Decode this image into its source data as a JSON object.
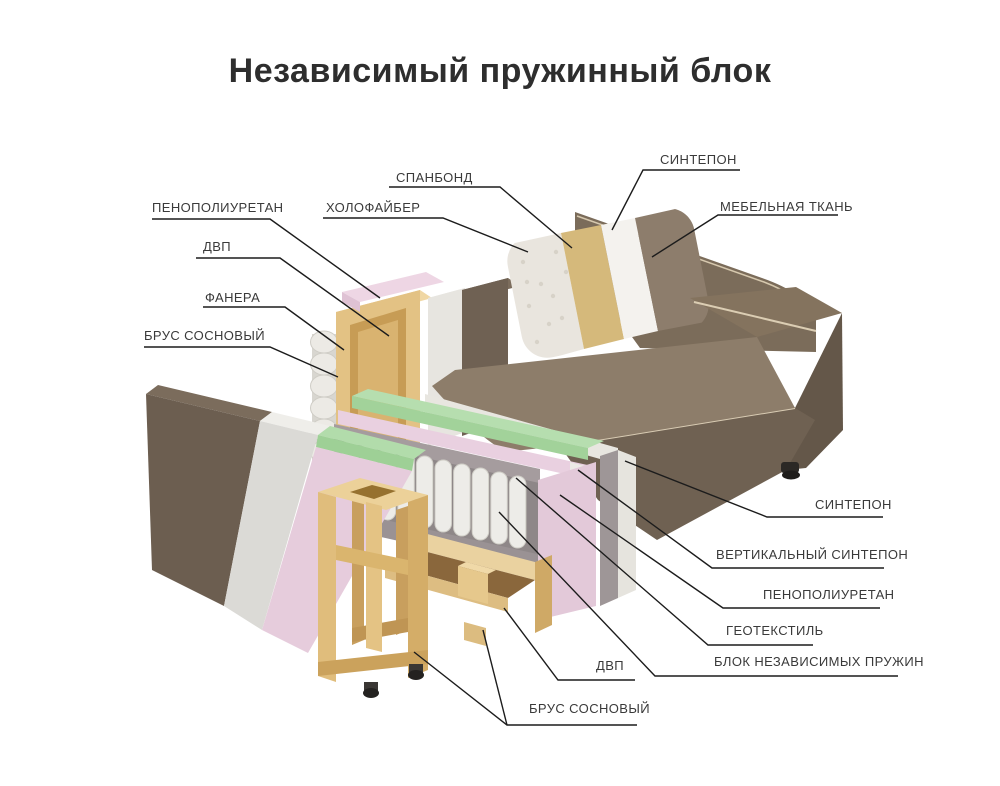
{
  "title": "Независимый пружинный блок",
  "labels": {
    "spanbond": "СПАНБОНД",
    "sintepon_top": "СИНТЕПОН",
    "holofiber": "ХОЛОФАЙБЕР",
    "mebelnaya_tkan": "МЕБЕЛЬНАЯ ТКАНЬ",
    "penopoliuretan_left": "ПЕНОПОЛИУРЕТАН",
    "dvp_left": "ДВП",
    "fanera": "ФАНЕРА",
    "brus_left": "БРУС СОСНОВЫЙ",
    "sintepon_right": "СИНТЕПОН",
    "vertikalny_sintepon": "ВЕРТИКАЛЬНЫЙ СИНТЕПОН",
    "penopoliuretan_right": "ПЕНОПОЛИУРЕТАН",
    "geotekstil": "ГЕОТЕКСТИЛЬ",
    "blok_pruzhin": "БЛОК НЕЗАВИСИМЫХ ПРУЖИН",
    "dvp_bottom": "ДВП",
    "brus_bottom": "БРУС СОСНОВЫЙ"
  },
  "materials": {
    "fabric_brown": "#6f6152",
    "fabric_brown_light": "#8d7d6a",
    "sintepon_white": "#e8e6e0",
    "holofiber_white": "#e9e5de",
    "spunbond_tan": "#d5b97b",
    "foam_pink": "#e6ccdc",
    "foam_green": "#aedaa6",
    "geotextile_grey": "#a29a9b",
    "pine_wood": "#e0bd7c",
    "springs_white": "#edece8",
    "leader_line": "#1c1c1c"
  }
}
